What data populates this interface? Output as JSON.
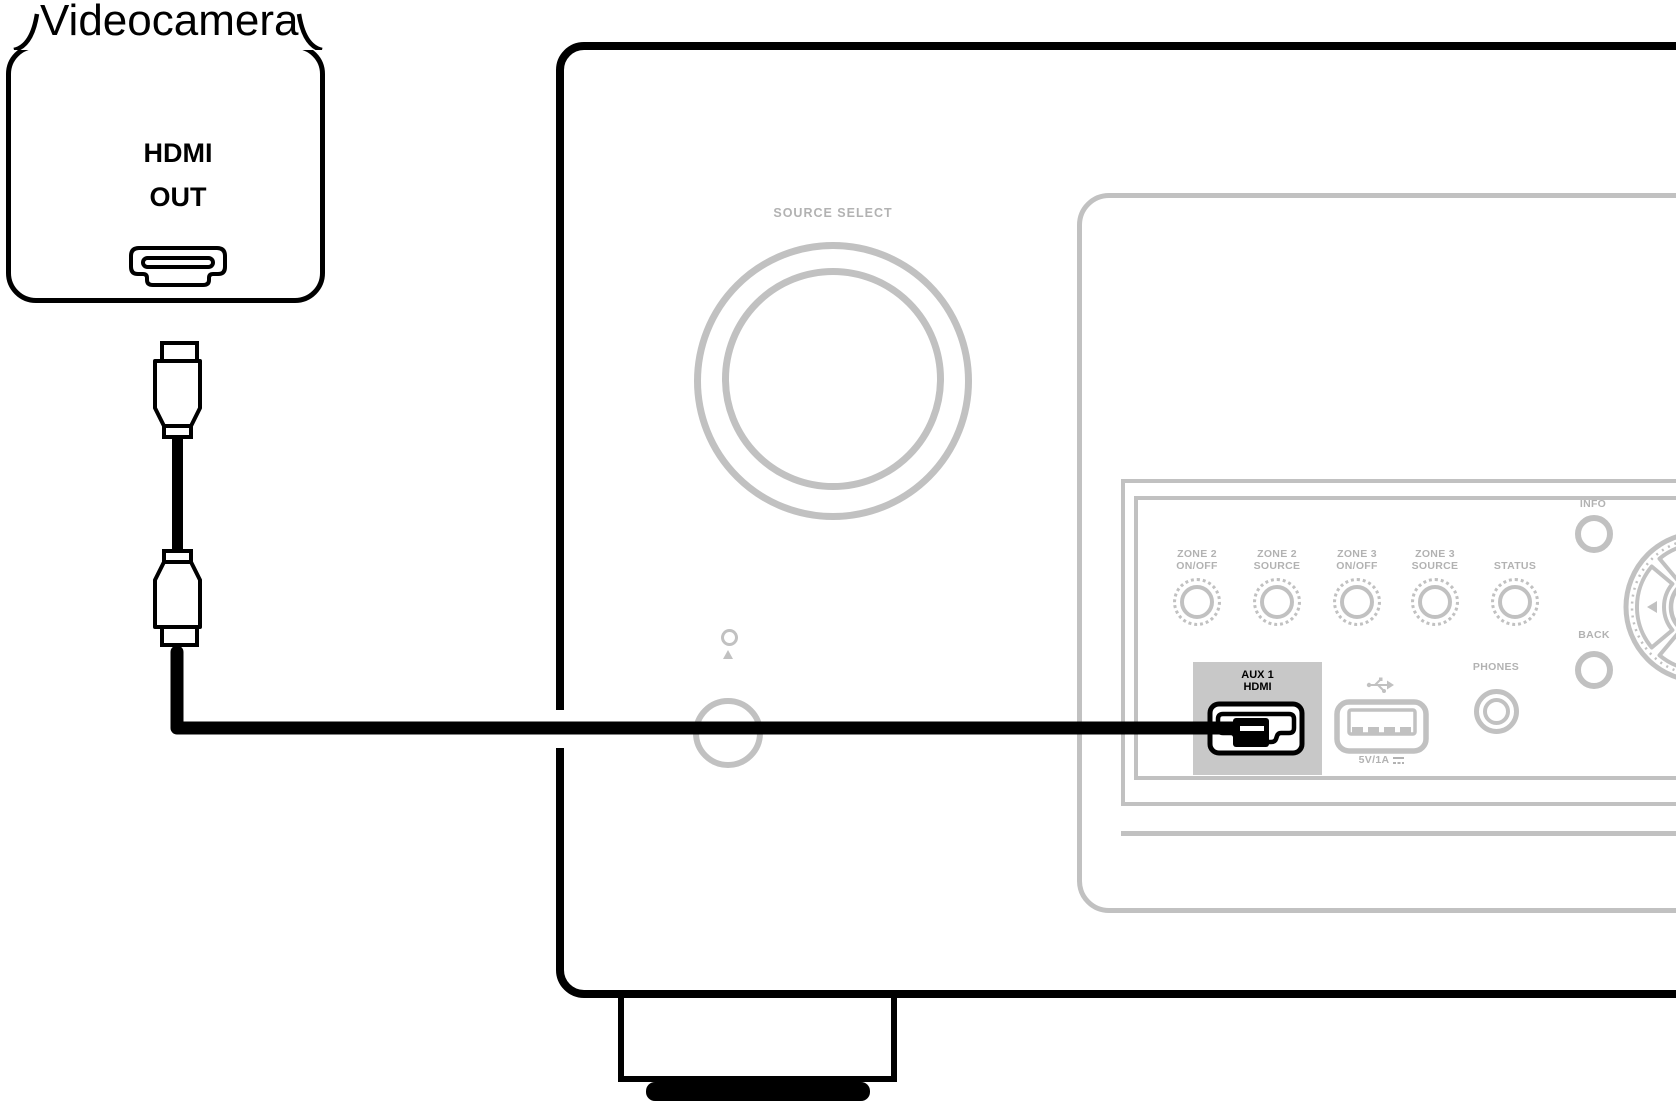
{
  "camera": {
    "name": "Videocamera",
    "port": {
      "line1": "HDMI",
      "line2": "OUT"
    }
  },
  "receiver": {
    "source_select_label": "SOURCE SELECT",
    "panel_buttons": [
      {
        "lines": [
          "ZONE 2",
          "ON/OFF"
        ]
      },
      {
        "lines": [
          "ZONE 2",
          "SOURCE"
        ]
      },
      {
        "lines": [
          "ZONE 3",
          "ON/OFF"
        ]
      },
      {
        "lines": [
          "ZONE 3",
          "SOURCE"
        ]
      },
      {
        "lines": [
          "STATUS"
        ]
      }
    ],
    "info_label": "INFO",
    "back_label": "BACK",
    "phones_label": "PHONES",
    "aux_input": {
      "line1": "AUX 1",
      "line2": "HDMI"
    },
    "usb": {
      "power_label": "5V/1A"
    }
  },
  "icons": {
    "camera_port": "hdmi-port-icon",
    "aux_port": "hdmi-port-icon",
    "usb_symbol": "usb-trident-icon",
    "usb_port": "usb-a-port-icon",
    "dc_power": "dc-power-icon",
    "phones_jack": "headphone-jack-icon",
    "cursor_pad": "cursor-pad",
    "cable": "hdmi-cable"
  },
  "colors": {
    "ink": "#000000",
    "panel_stroke": "#c1c1c1",
    "label_text": "#b2b2b2",
    "aux_highlight_fill": "#c8c8c8",
    "background": "#ffffff"
  }
}
